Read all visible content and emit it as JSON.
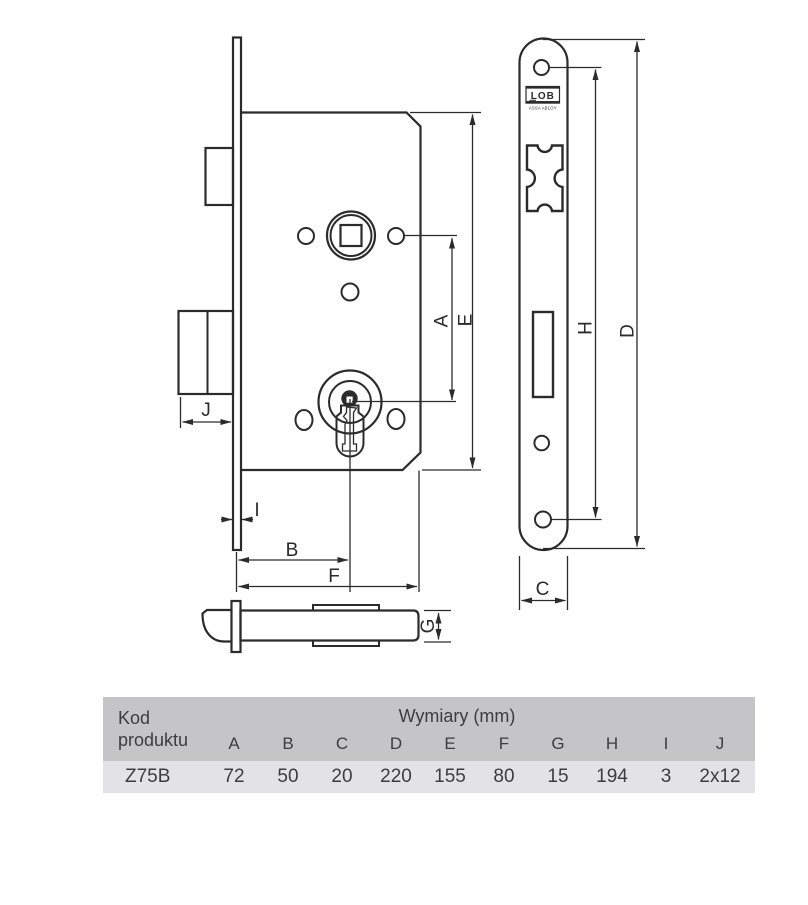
{
  "diagram": {
    "line_color": "#2b2b2b",
    "dim_labels": {
      "A": "A",
      "B": "B",
      "C": "C",
      "D": "D",
      "E": "E",
      "F": "F",
      "G": "G",
      "H": "H",
      "I": "I",
      "J": "J"
    },
    "faceplate_logo": {
      "brand": "LOB",
      "subbrand": "ASSA ABLOY"
    }
  },
  "table": {
    "product_code_header": "Kod produktu",
    "dimensions_header": "Wymiary (mm)",
    "columns": [
      "A",
      "B",
      "C",
      "D",
      "E",
      "F",
      "G",
      "H",
      "I",
      "J"
    ],
    "row": {
      "product_code": "Z75B",
      "values": [
        "72",
        "50",
        "20",
        "220",
        "155",
        "80",
        "15",
        "194",
        "3",
        "2x12"
      ]
    },
    "colors": {
      "header_bg": "#c5c5c8",
      "row_bg": "#e3e3e7",
      "text": "#3d3d3f"
    }
  }
}
